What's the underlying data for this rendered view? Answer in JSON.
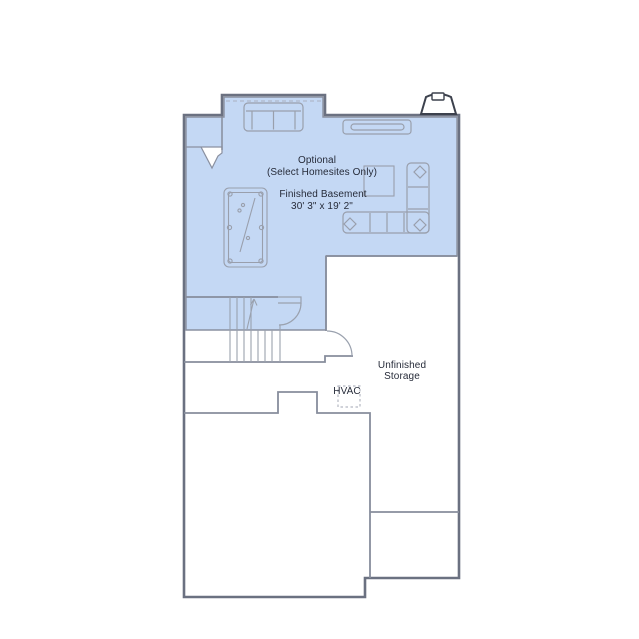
{
  "plan": {
    "optional_note": {
      "line1": "Optional",
      "line2": "(Select Homesites Only)"
    },
    "finished_basement": {
      "name": "Finished Basement",
      "dimensions": "30' 3\" x 19' 2\""
    },
    "storage": {
      "line1": "Unfinished",
      "line2": "Storage"
    },
    "hvac": {
      "label": "HVAC"
    },
    "colors": {
      "highlight_fill": "#c4d8f4",
      "highlight_edge": "#8a90a0",
      "outer_wall": "#6b7181",
      "partition": "#878d9c",
      "furniture": "#999fac",
      "fireplace": "#3c414d",
      "text": "#262b39"
    }
  }
}
